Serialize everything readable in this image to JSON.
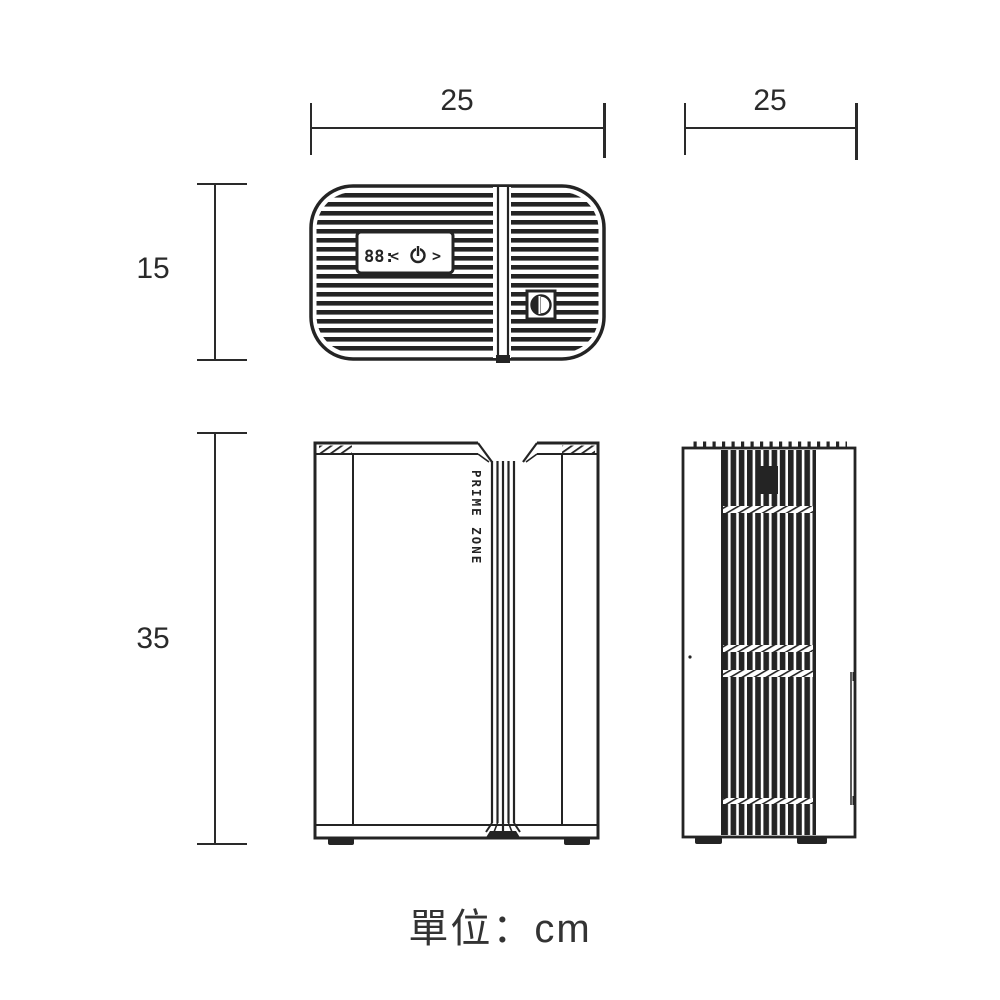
{
  "page": {
    "background": "#ffffff",
    "ink": "#242424"
  },
  "dimension_labels": {
    "top_view_width": "25",
    "side_view_width": "25",
    "top_view_height": "15",
    "front_view_height": "35"
  },
  "unit_note": "單位：cm",
  "front_view": {
    "brand": "PRIME ZONE"
  },
  "top_view": {
    "display": "88:",
    "prev_button": "<",
    "next_button": ">"
  }
}
